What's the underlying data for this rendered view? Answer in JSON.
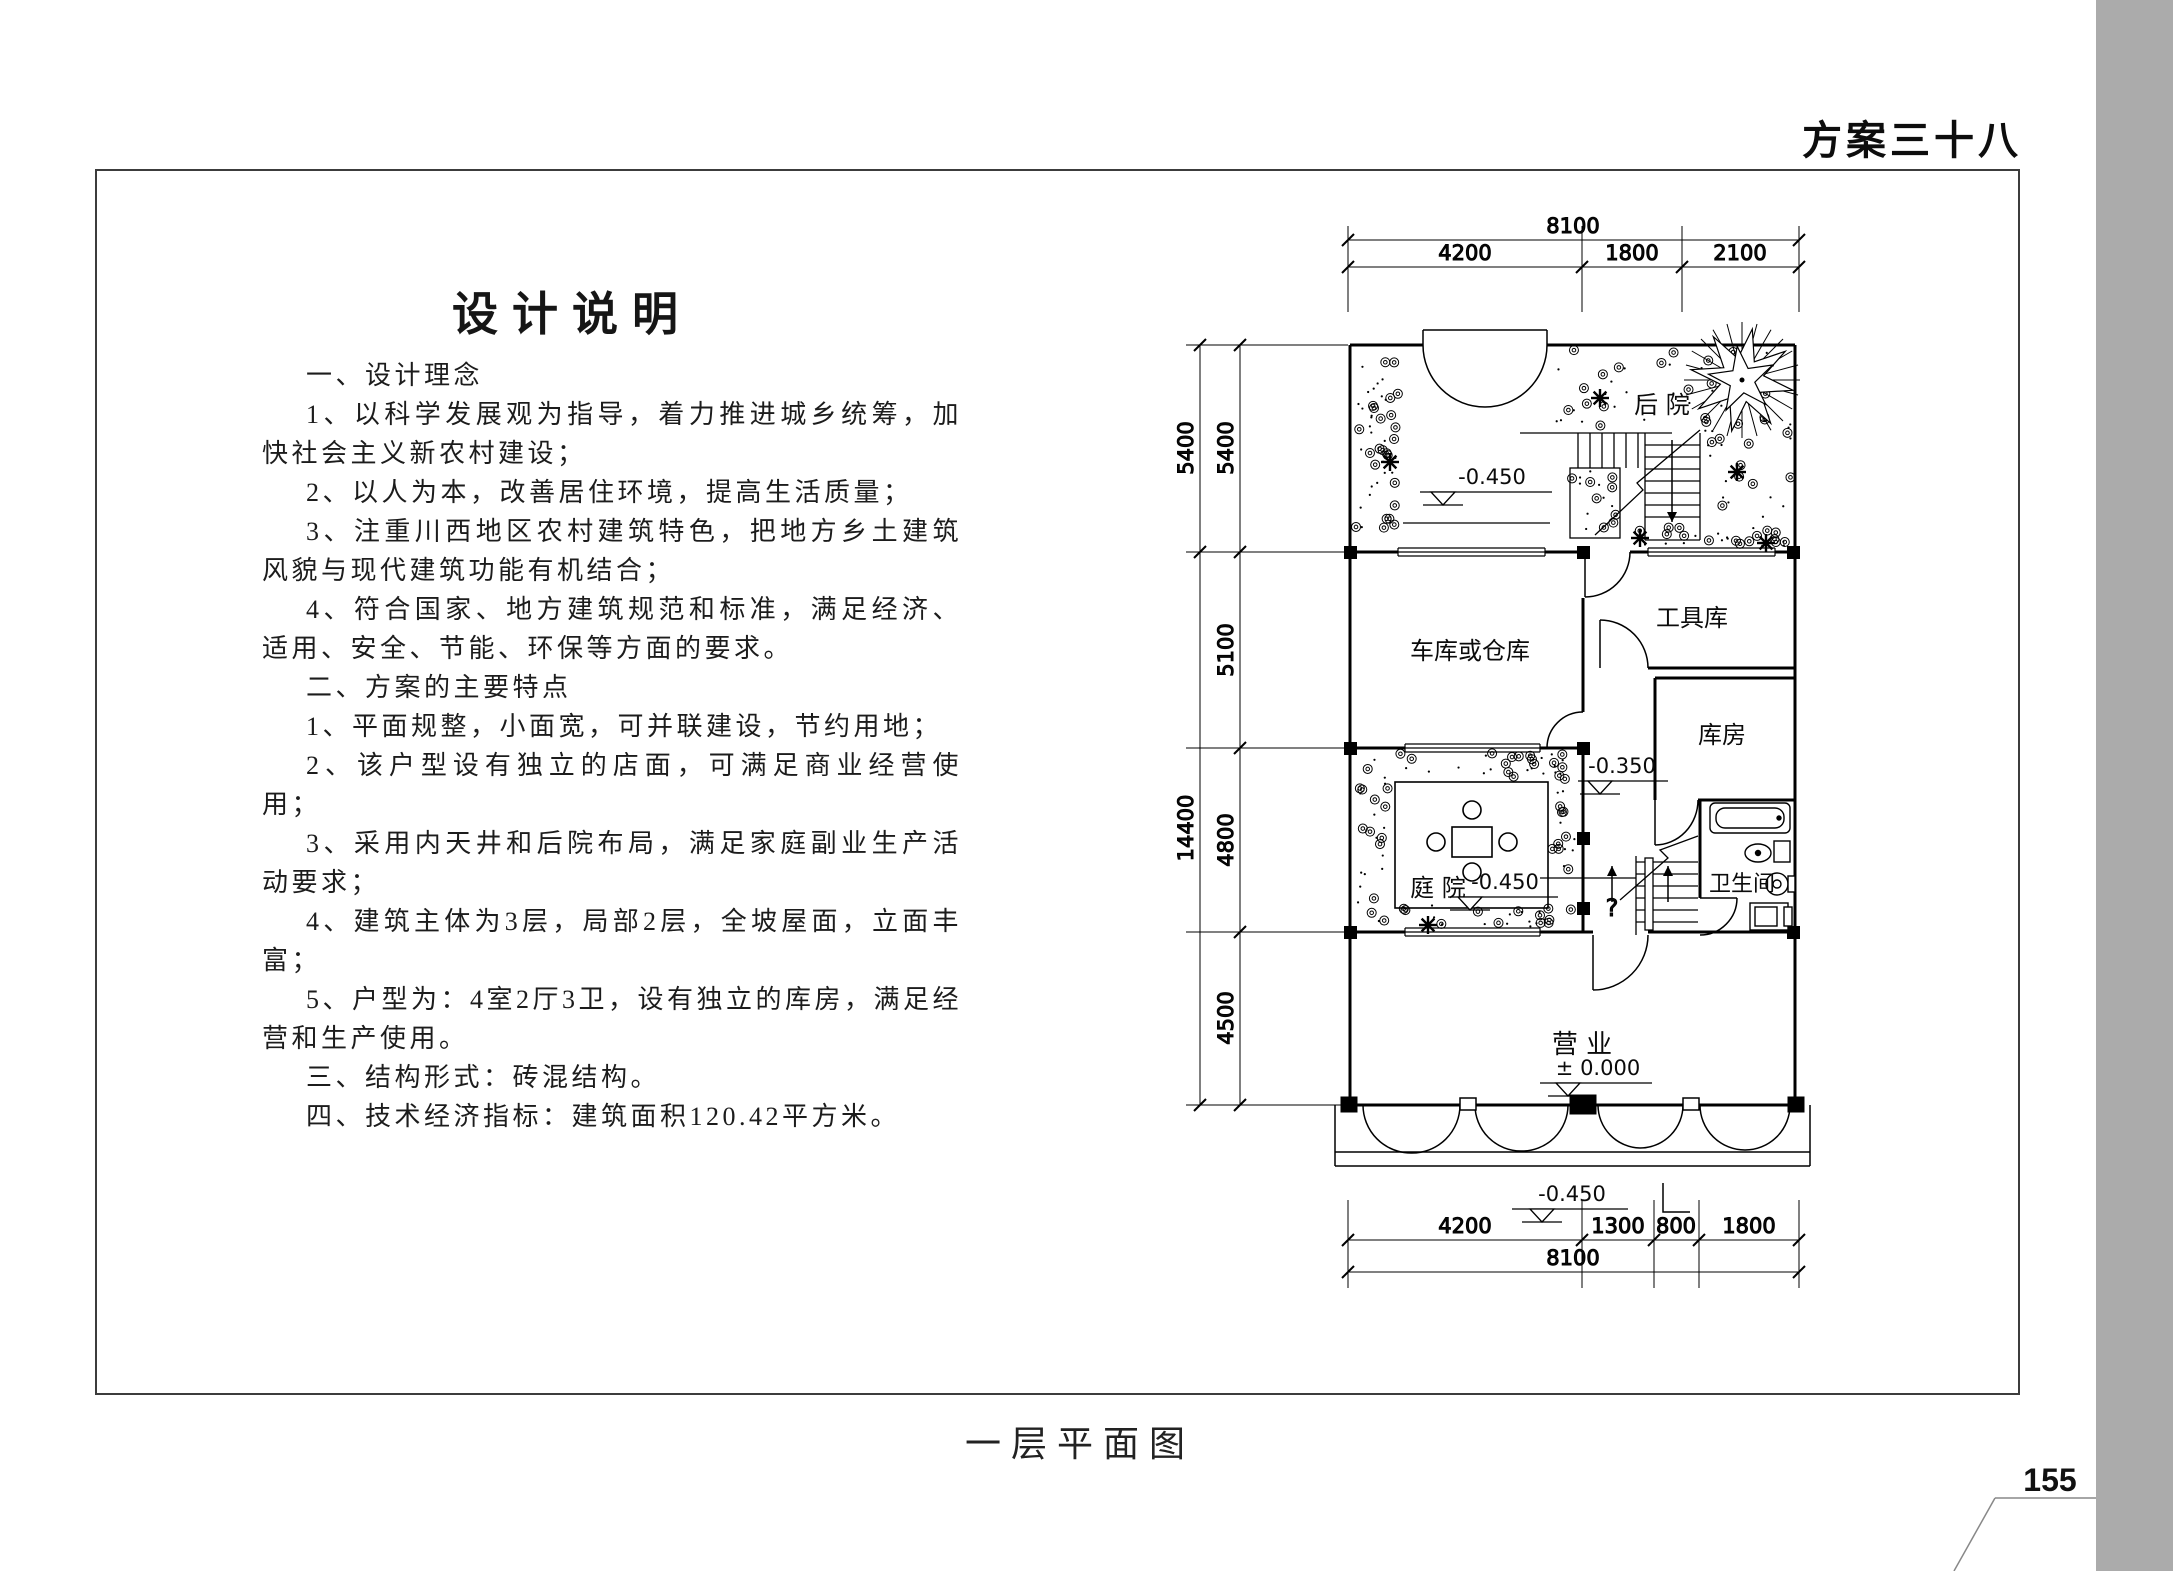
{
  "page": {
    "header_title": "方案三十八",
    "page_number": "155",
    "footer_caption": "一层平面图"
  },
  "design_notes": {
    "title": "设计说明",
    "paragraphs": [
      "一、设计理念",
      "1、以科学发展观为指导，着力推进城乡统筹，加快社会主义新农村建设；",
      "2、以人为本，改善居住环境，提高生活质量；",
      "3、注重川西地区农村建筑特色，把地方乡土建筑风貌与现代建筑功能有机结合；",
      "4、符合国家、地方建筑规范和标准，满足经济、适用、安全、节能、环保等方面的要求。",
      "二、方案的主要特点",
      "1、平面规整，小面宽，可并联建设，节约用地；",
      "2、该户型设有独立的店面，可满足商业经营使用；",
      "3、采用内天井和后院布局，满足家庭副业生产活动要求；",
      "4、建筑主体为3层，局部2层，全坡屋面，立面丰富；",
      "5、户型为：4室2厅3卫，设有独立的库房，满足经营和生产使用。",
      "三、结构形式：砖混结构。",
      "四、技术经济指标：建筑面积120.42平方米。"
    ]
  },
  "plan": {
    "rooms": {
      "backyard": "后  院",
      "garage": "车库或仓库",
      "tool": "工具库",
      "storeroom": "库房",
      "courtyard": "庭  院",
      "bathroom": "卫生间",
      "shop": "营  业"
    },
    "levels": {
      "upper": "-0.450",
      "hall": "-0.350",
      "courtyard": "-0.450",
      "shop": "± 0.000",
      "porch": "-0.450"
    },
    "stair_mark": "?",
    "dims": {
      "top_total": "8100",
      "top": [
        "4200",
        "1800",
        "2100"
      ],
      "bottom": [
        "4200",
        "1300",
        "800",
        "1800"
      ],
      "bottom_total": "8100",
      "left_outer": [
        "5400",
        "14400"
      ],
      "left_inner": [
        "5400",
        "5100",
        "4800",
        "4500"
      ]
    }
  }
}
